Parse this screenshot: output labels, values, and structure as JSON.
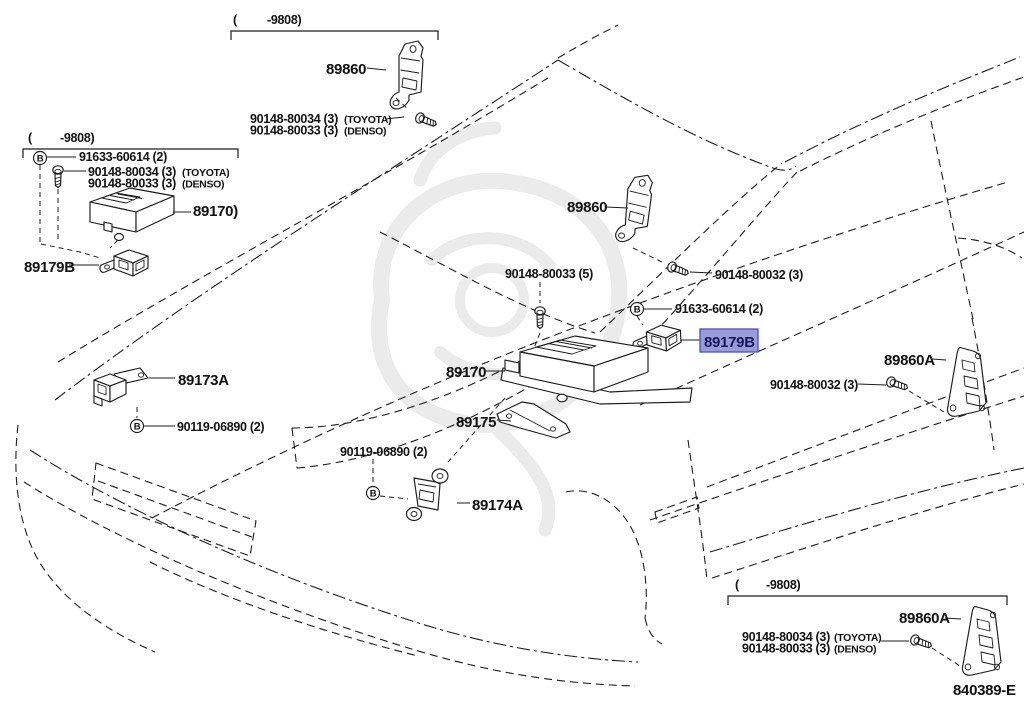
{
  "diagram": {
    "figure_code": "840389-E",
    "selected_part": "89179B",
    "highlight_bg": "#989dda",
    "highlight_border": "#4a52bc",
    "b_symbol": "B",
    "callouts": {
      "top": {
        "paren": "(",
        "date": "-9808)",
        "part": "89860",
        "screw1": "90148-80034 (3)",
        "maker1": "(TOYOTA)",
        "screw2": "90148-80033 (3)",
        "maker2": "(DENSO)"
      },
      "left": {
        "paren": "(",
        "date": "-9808)",
        "bolt": "91633-60614 (2)",
        "screw1": "90148-80034 (3)",
        "maker1": "(TOYOTA)",
        "screw2": "90148-80033 (3)",
        "maker2": "(DENSO)",
        "ecu": "89170)",
        "sensor": "89179B"
      },
      "cowl": {
        "part": "89860",
        "screw": "90148-80032 (3)"
      },
      "center": {
        "screw5": "90148-80033 (5)",
        "bolt": "91633-60614 (2)",
        "sensor": "89179B",
        "ecu": "89170",
        "bracket": "89175"
      },
      "front_left": {
        "sensor": "89173A",
        "nut": "90119-06890 (2)"
      },
      "front_center": {
        "nut": "90119-06890 (2)",
        "sensor": "89174A"
      },
      "right": {
        "part": "89860A",
        "screw": "90148-80032 (3)"
      },
      "bottom_right": {
        "paren": "(",
        "date": "-9808)",
        "part": "89860A",
        "screw1": "90148-80034 (3)",
        "maker1": "(TOYOTA)",
        "screw2": "90148-80033 (3)",
        "maker2": "(DENSO)"
      }
    }
  }
}
